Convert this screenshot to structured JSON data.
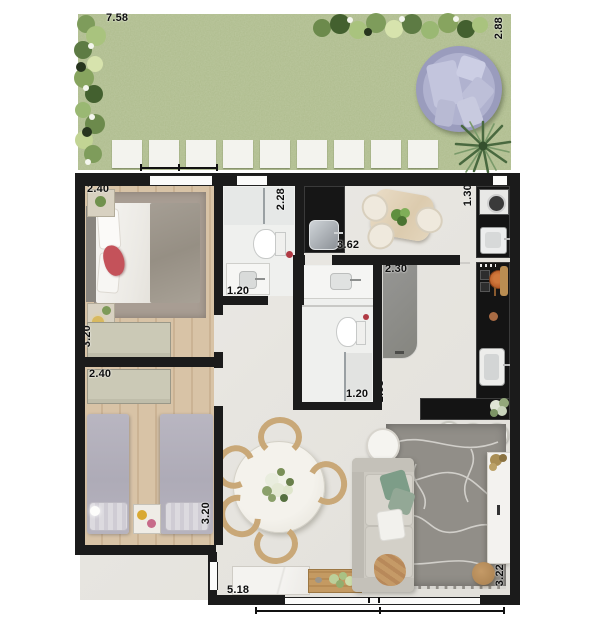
{
  "title": "apartment-garden-floor-plan",
  "dimensions": {
    "garden_width": "7.58",
    "garden_depth": "2.88",
    "bedroom1_width": "2.40",
    "bedroom1_depth": "3.20",
    "bathroom1_depth": "2.28",
    "bathroom1_width": "1.20",
    "service_width": "3.62",
    "bathroom2_depth": "2.58",
    "closet_width": "2.30",
    "kitchen_width": "1.30",
    "bathroom2_width": "1.20",
    "corridor_depth": "2.58",
    "bedroom2_width": "2.40",
    "bedroom2_depth": "3.20",
    "living_width": "5.18",
    "living_depth": "3.22"
  },
  "colors": {
    "wall": "#1b1b1b",
    "grass": "#adbb8c",
    "wood_floor": "#d6c1a4",
    "tile_floor": "#e9e7e2",
    "counter_granite": "#141414",
    "daybed": "#a9abc8",
    "sofa": "#ccc9c1",
    "rug_living": "#918e88",
    "accent_red_pillow": "#c4525a",
    "closet_panel": "#8e8e8c"
  }
}
